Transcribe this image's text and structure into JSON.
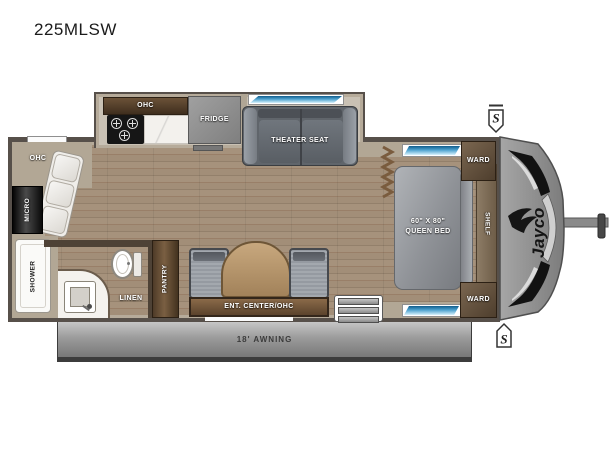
{
  "title": "225MLSW",
  "labels": {
    "kitchen_ohc": "OHC",
    "fridge": "FRIDGE",
    "theater_seat": "THEATER SEAT",
    "rear_ohc": "OHC",
    "micro": "MICRO",
    "shower": "SHOWER",
    "linen": "LINEN",
    "pantry": "PANTRY",
    "ent_center": "ENT. CENTER/OHC",
    "ward_top": "WARD",
    "ward_bottom": "WARD",
    "shelf": "SHELF",
    "bed_size": "60\" x 80\"",
    "bed_type": "QUEEN BED",
    "awning": "18' AWNING",
    "brand": "Jayco",
    "marker_top": "S",
    "marker_bottom": "S"
  },
  "colors": {
    "wall": "#57504a",
    "wall_lining": "#b6ab9a",
    "floor_wood": "#9c8873",
    "cabinet_dark": "#4a3826",
    "window_blue": "#1a6fa8",
    "awning_gray": "#8f8f8f",
    "seat_gray": "#60656b",
    "bed_gray": "#999da2",
    "marker_orange": "#e59b3a"
  }
}
